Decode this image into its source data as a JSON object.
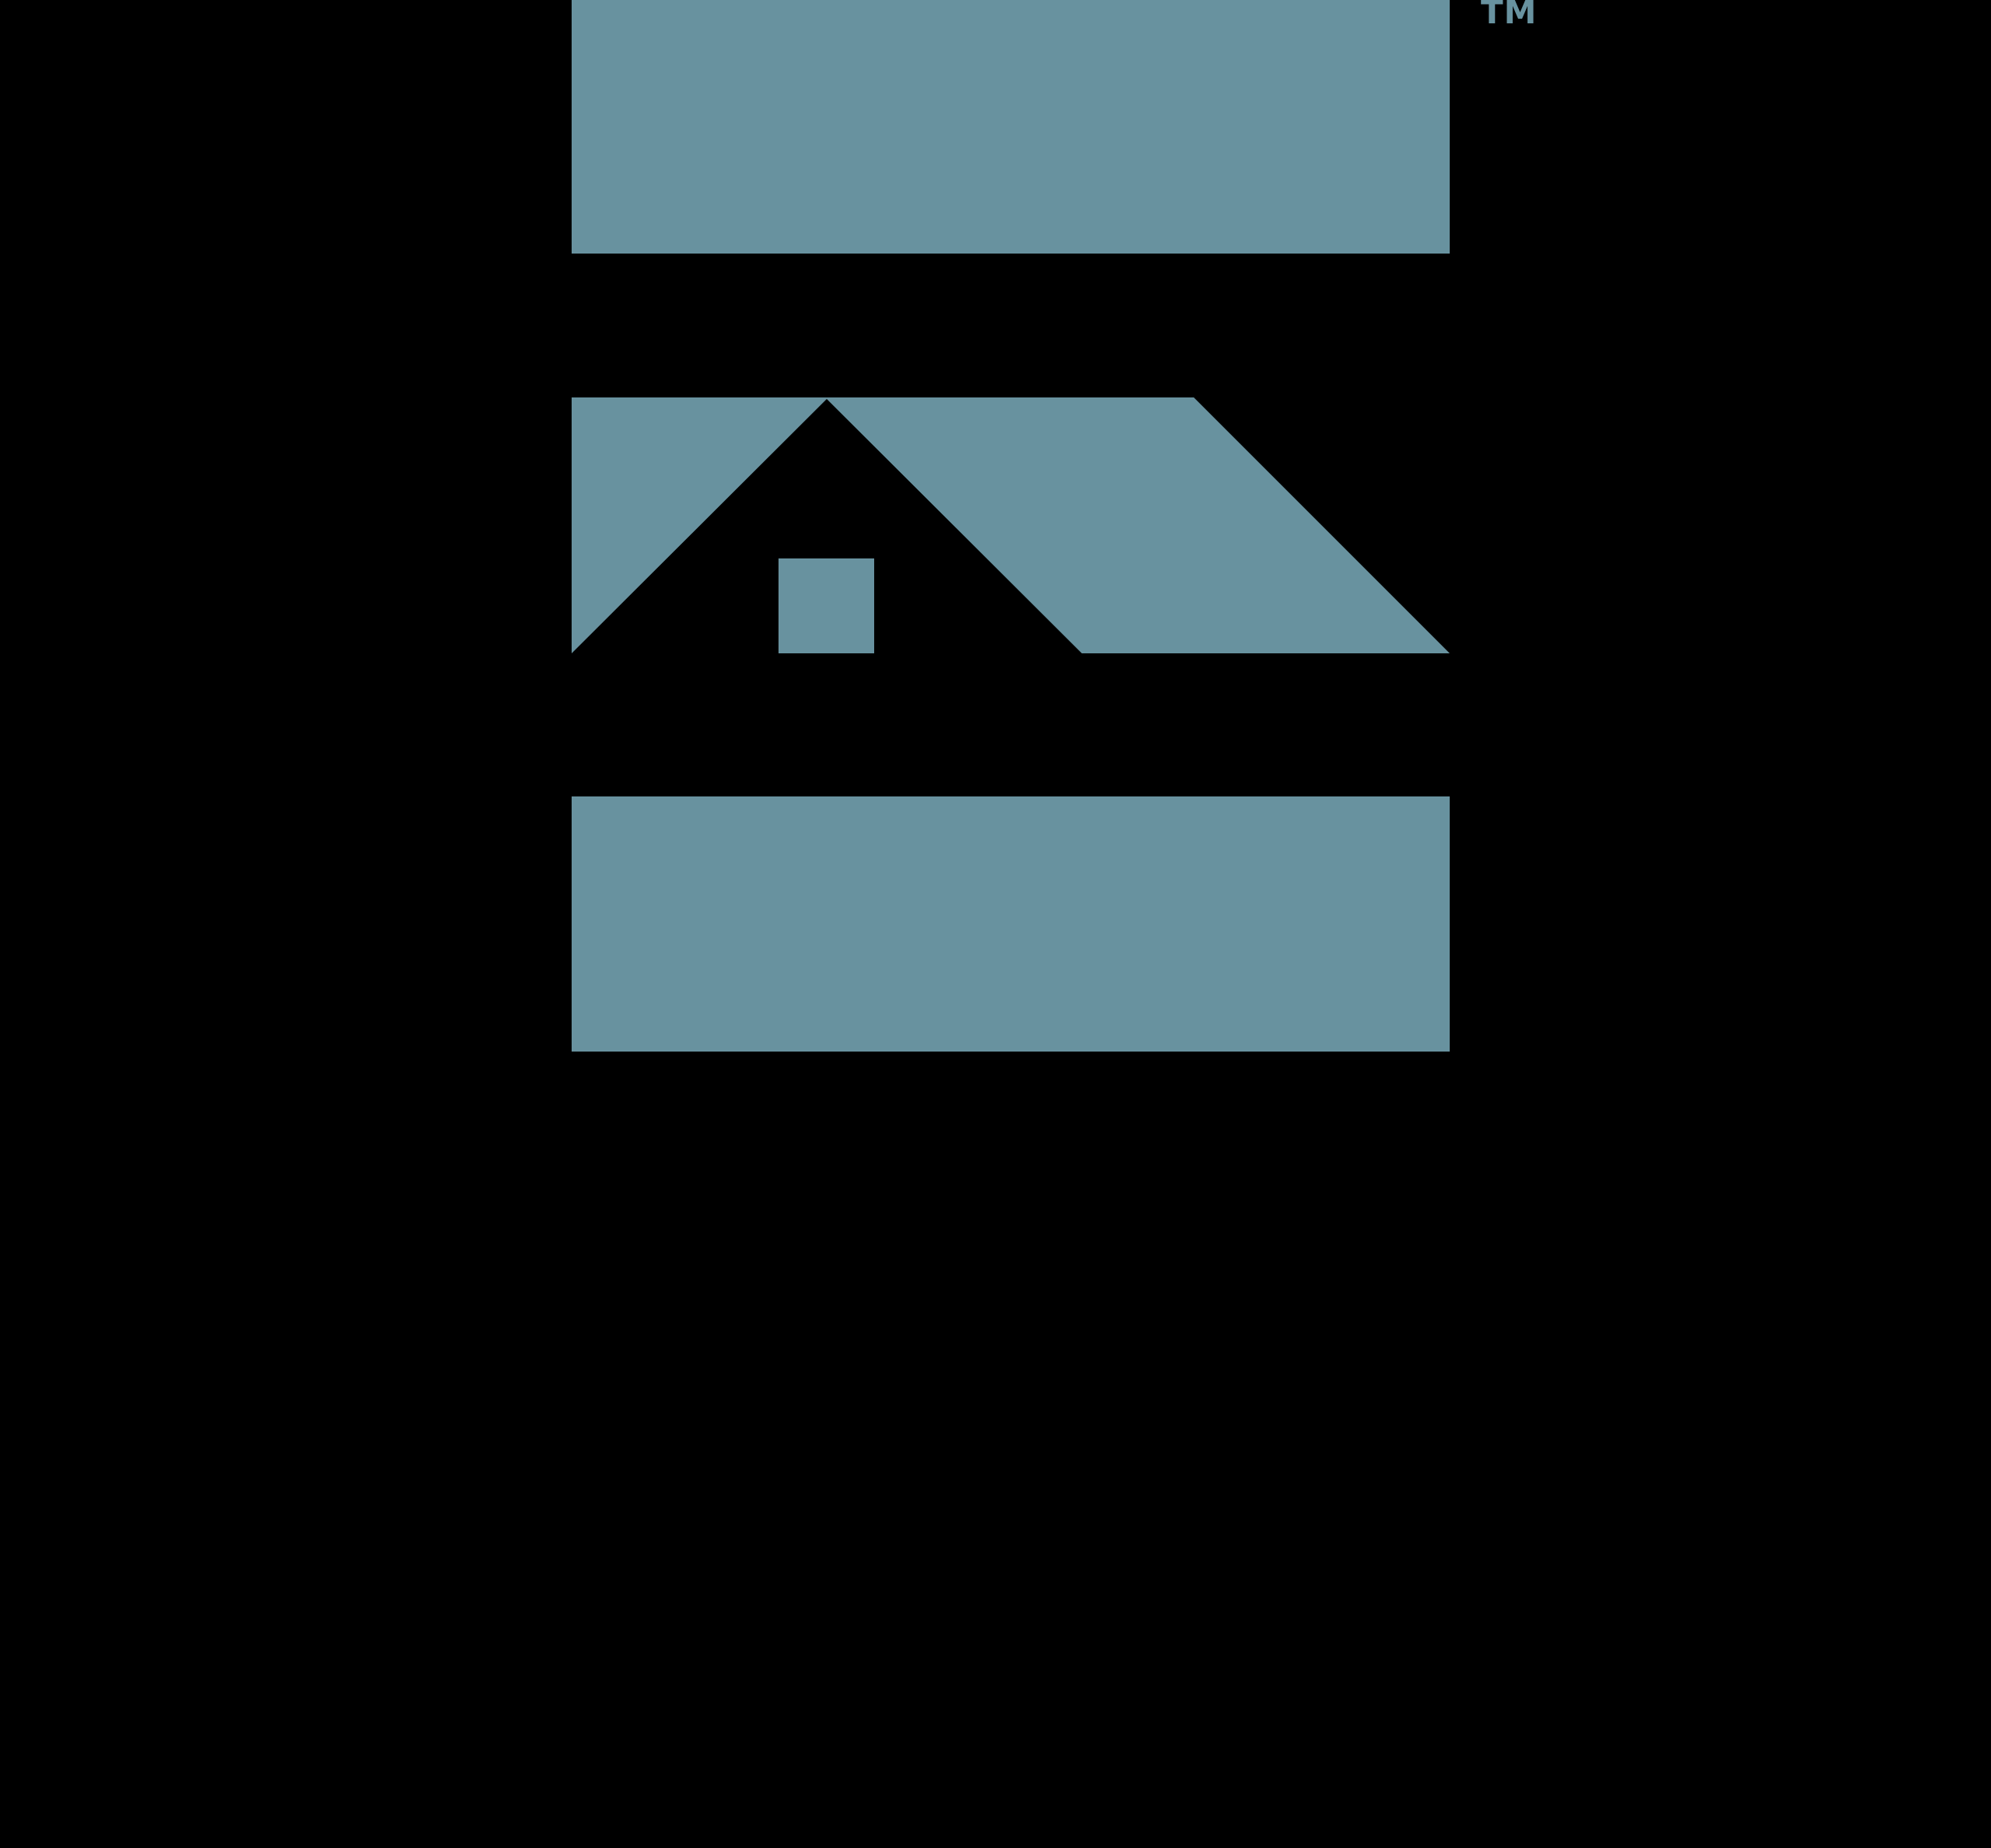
{
  "logo": {
    "trademark": "TM",
    "parts": {
      "top_bar": "top-bar",
      "house_band": "middle-band-with-house-roof-and-window",
      "bottom_bar": "bottom-bar"
    }
  },
  "colors": {
    "logo_teal": "#68929F",
    "background": "#000000"
  }
}
